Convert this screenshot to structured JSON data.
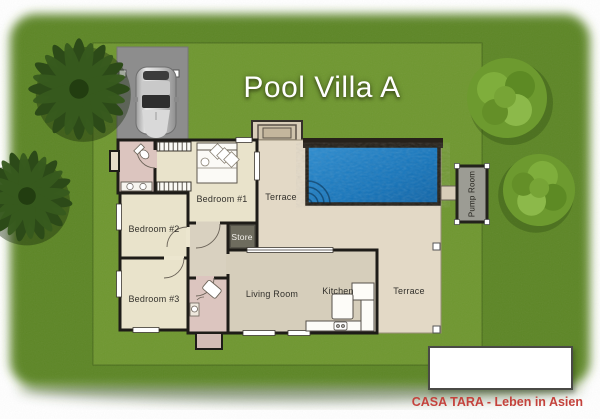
{
  "title": "Pool Villa A",
  "branding": "CASA TARA - Leben in Asien",
  "rooms": {
    "bedroom1": "Bedroom #1",
    "bedroom2": "Bedroom #2",
    "bedroom3": "Bedroom #3",
    "living_room": "Living Room",
    "kitchen": "Kitchen",
    "terrace_upper": "Terrace",
    "terrace_right": "Terrace",
    "store": "Store",
    "pump_room": "Pump Room"
  },
  "colors": {
    "lawn_outer": "#5d8626",
    "lawn_inner": "#6f9730",
    "pool_water": "#1577bd",
    "terrace_floor": "#e3d9c6",
    "bedroom_floor": "#e9e3cb",
    "bathroom_floor": "#dcc5bf",
    "living_floor": "#d6cebb",
    "store_floor": "#6e6c5e",
    "wall": "#1e1c18",
    "driveway": "#8d8d8d",
    "brand_red": "#c4423c",
    "title_text": "#ffffff"
  }
}
